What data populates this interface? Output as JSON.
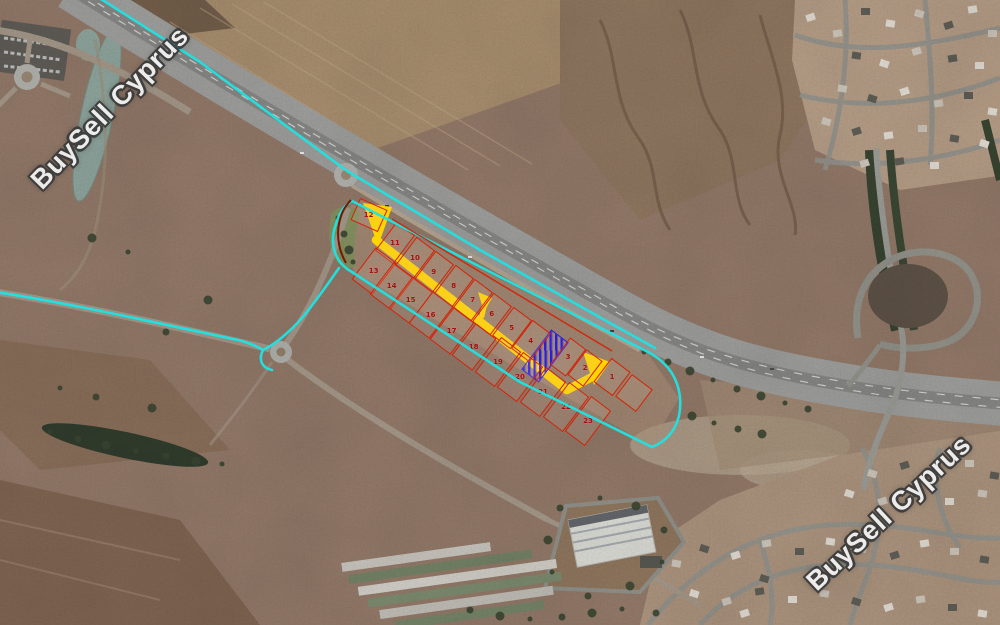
{
  "watermark_text": "BuySell Cyprus",
  "annotations": {
    "boundary_color": "#1fe3e3",
    "plot_outline_color": "#d32206",
    "plot_number_color": "#a50e0e",
    "access_road_color": "#ffd400",
    "highlight_plot_color": "#2a1de8",
    "plots": [
      {
        "label": "12",
        "x": 369,
        "y": 215,
        "w": 30,
        "h": 24,
        "r": 24
      },
      {
        "label": "11",
        "x": 395,
        "y": 243,
        "w": 23,
        "h": 36,
        "r": 37
      },
      {
        "label": "10",
        "x": 415,
        "y": 258,
        "w": 23,
        "h": 36,
        "r": 37
      },
      {
        "label": "9",
        "x": 434,
        "y": 272,
        "w": 23,
        "h": 36,
        "r": 37
      },
      {
        "label": "8",
        "x": 454,
        "y": 286,
        "w": 23,
        "h": 36,
        "r": 37
      },
      {
        "label": "7",
        "x": 473,
        "y": 300,
        "w": 23,
        "h": 36,
        "r": 37
      },
      {
        "label": "6",
        "x": 492,
        "y": 314,
        "w": 23,
        "h": 36,
        "r": 37
      },
      {
        "label": "5",
        "x": 512,
        "y": 328,
        "w": 23,
        "h": 36,
        "r": 37
      },
      {
        "label": "4",
        "x": 531,
        "y": 341,
        "w": 23,
        "h": 36,
        "r": 37
      },
      {
        "label": "3",
        "x": 568,
        "y": 357,
        "w": 20,
        "h": 34,
        "r": 37
      },
      {
        "label": "2",
        "x": 585,
        "y": 368,
        "w": 20,
        "h": 32,
        "r": 37
      },
      {
        "label": "1",
        "x": 612,
        "y": 377,
        "w": 24,
        "h": 30,
        "r": 37
      },
      {
        "label": "13",
        "x": 374,
        "y": 271,
        "w": 26,
        "h": 40,
        "r": 37
      },
      {
        "label": "14",
        "x": 392,
        "y": 286,
        "w": 26,
        "h": 40,
        "r": 37
      },
      {
        "label": "15",
        "x": 411,
        "y": 300,
        "w": 26,
        "h": 40,
        "r": 37
      },
      {
        "label": "16",
        "x": 431,
        "y": 315,
        "w": 26,
        "h": 40,
        "r": 37
      },
      {
        "label": "17",
        "x": 452,
        "y": 331,
        "w": 26,
        "h": 40,
        "r": 37
      },
      {
        "label": "18",
        "x": 474,
        "y": 347,
        "w": 26,
        "h": 40,
        "r": 37
      },
      {
        "label": "19",
        "x": 498,
        "y": 362,
        "w": 25,
        "h": 44,
        "r": 37
      },
      {
        "label": "20",
        "x": 520,
        "y": 377,
        "w": 25,
        "h": 44,
        "r": 37
      },
      {
        "label": "21",
        "x": 543,
        "y": 392,
        "w": 25,
        "h": 44,
        "r": 37
      },
      {
        "label": "22",
        "x": 566,
        "y": 407,
        "w": 25,
        "h": 44,
        "r": 37
      },
      {
        "label": "23",
        "x": 588,
        "y": 421,
        "w": 25,
        "h": 44,
        "r": 37
      },
      {
        "label": "",
        "x": 634,
        "y": 393,
        "w": 26,
        "h": 28,
        "r": 37
      }
    ],
    "highlight_plot": {
      "x": 545,
      "y": 356,
      "w": 22,
      "h": 50,
      "r": 37
    }
  }
}
